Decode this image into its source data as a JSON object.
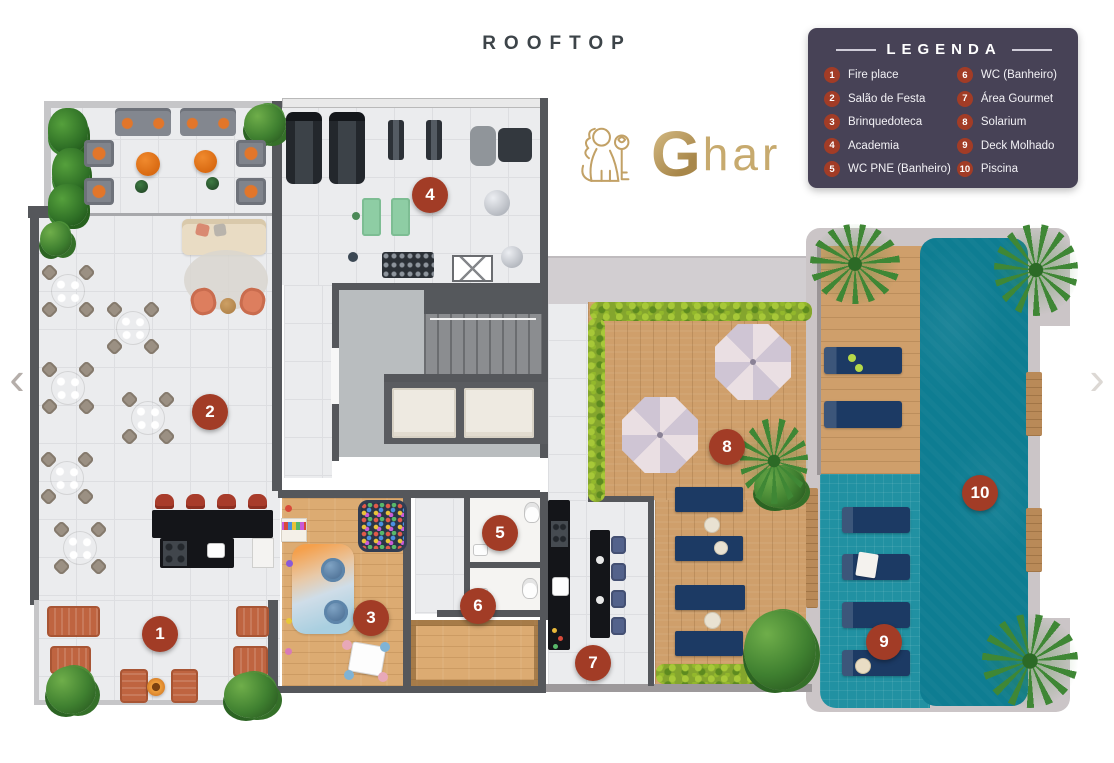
{
  "title": "ROOFTOP",
  "nav": {
    "prev": "‹",
    "next": "›"
  },
  "logo": {
    "brand": "Ghar",
    "initial": "G",
    "rest": "har"
  },
  "legend": {
    "title": "LEGENDA",
    "columns": [
      [
        {
          "n": "1",
          "label": "Fire place"
        },
        {
          "n": "2",
          "label": "Salão de Festa"
        },
        {
          "n": "3",
          "label": "Brinquedoteca"
        },
        {
          "n": "4",
          "label": "Academia"
        },
        {
          "n": "5",
          "label": "WC PNE (Banheiro)"
        }
      ],
      [
        {
          "n": "6",
          "label": "WC (Banheiro)"
        },
        {
          "n": "7",
          "label": "Área Gourmet"
        },
        {
          "n": "8",
          "label": "Solarium"
        },
        {
          "n": "9",
          "label": "Deck Molhado"
        },
        {
          "n": "10",
          "label": "Piscina"
        }
      ]
    ]
  },
  "markers": [
    {
      "n": "1",
      "label": "Fire place",
      "x": 160,
      "y": 634
    },
    {
      "n": "2",
      "label": "Salão de Festa",
      "x": 210,
      "y": 412
    },
    {
      "n": "3",
      "label": "Brinquedoteca",
      "x": 371,
      "y": 618
    },
    {
      "n": "4",
      "label": "Academia",
      "x": 430,
      "y": 195
    },
    {
      "n": "5",
      "label": "WC PNE (Banheiro)",
      "x": 500,
      "y": 533
    },
    {
      "n": "6",
      "label": "WC (Banheiro)",
      "x": 478,
      "y": 606
    },
    {
      "n": "7",
      "label": "Área Gourmet",
      "x": 593,
      "y": 663
    },
    {
      "n": "8",
      "label": "Solarium",
      "x": 727,
      "y": 447
    },
    {
      "n": "9",
      "label": "Deck Molhado",
      "x": 884,
      "y": 642
    },
    {
      "n": "10",
      "label": "Piscina",
      "x": 980,
      "y": 493
    }
  ],
  "colors": {
    "marker": "#A23C26",
    "legend_bg": "#474256",
    "pool": "#0E7D92",
    "gold": "#C2A166"
  }
}
